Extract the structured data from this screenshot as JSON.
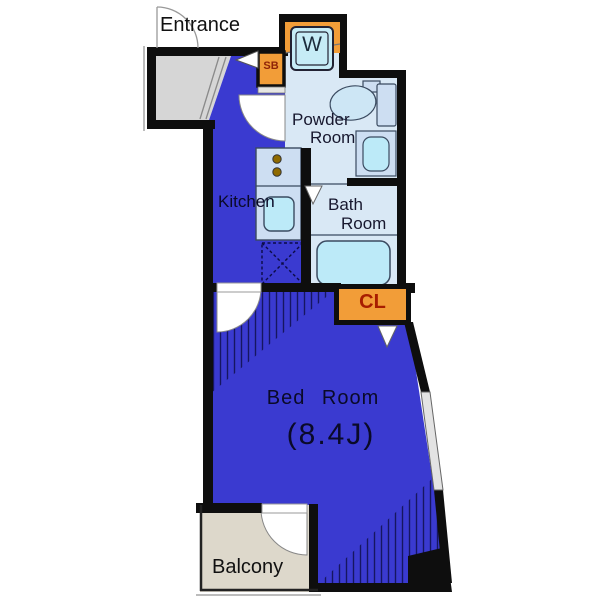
{
  "floorplan": {
    "title": "1K apartment floor plan",
    "labels": {
      "entrance": "Entrance",
      "washer": "W",
      "shoe_box": "SB",
      "powder_room_line1": "Powder",
      "powder_room_line2": "Room",
      "kitchen": "Kitchen",
      "bath_room_line1": "Bath",
      "bath_room_line2": "Room",
      "closet": "CL",
      "bedroom": "Bed Room",
      "bedroom_size": "(8.4J)",
      "balcony": "Balcony"
    },
    "colors": {
      "floor_blue": "#3a3ad0",
      "room_light_blue": "#d9e8f5",
      "counter_blue": "#cddef2",
      "fixture_cyan": "#bceaf8",
      "washer_cyan": "#c6ecf6",
      "accent_orange": "#f29d38",
      "closet_text_red": "#a81d00",
      "shoebox_text_red": "#8f2408",
      "entrance_gray": "#d6d6d6",
      "balcony_beige": "#ddd8cb",
      "wall_black": "#0e0e0e",
      "hatch_navy": "#161660"
    }
  }
}
